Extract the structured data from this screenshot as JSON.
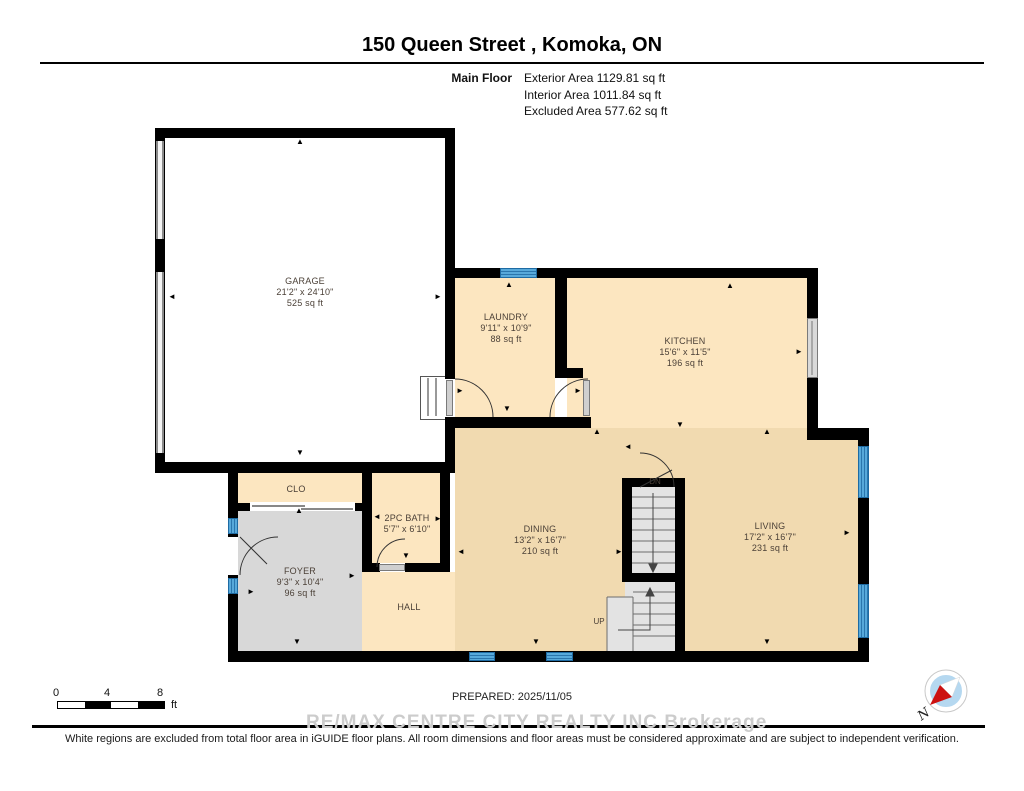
{
  "header": {
    "title": "150 Queen Street , Komoka, ON",
    "floor_label": "Main Floor",
    "stats": [
      "Exterior Area 1129.81 sq ft",
      "Interior Area 1011.84 sq ft",
      "Excluded Area 577.62 sq ft"
    ]
  },
  "rooms": [
    {
      "id": "garage",
      "name": "GARAGE",
      "dims": "21'2\" x 24'10\"",
      "area": "525 sq ft"
    },
    {
      "id": "laundry",
      "name": "LAUNDRY",
      "dims": "9'11\" x 10'9\"",
      "area": "88 sq ft"
    },
    {
      "id": "kitchen",
      "name": "KITCHEN",
      "dims": "15'6\" x 11'5\"",
      "area": "196 sq ft"
    },
    {
      "id": "dining",
      "name": "DINING",
      "dims": "13'2\" x 16'7\"",
      "area": "210 sq ft"
    },
    {
      "id": "living",
      "name": "LIVING",
      "dims": "17'2\" x 16'7\"",
      "area": "231 sq ft"
    },
    {
      "id": "foyer",
      "name": "FOYER",
      "dims": "9'3\" x 10'4\"",
      "area": "96 sq ft"
    },
    {
      "id": "bath",
      "name": "2PC BATH",
      "dims": "5'7\" x 6'10\"",
      "area": ""
    },
    {
      "id": "closet",
      "name": "CLO",
      "dims": "",
      "area": ""
    },
    {
      "id": "hall",
      "name": "HALL",
      "dims": "",
      "area": ""
    }
  ],
  "stairs": {
    "dn_label": "DN",
    "up_label": "UP"
  },
  "scale_bar": {
    "ticks": [
      "0",
      "4",
      "8"
    ],
    "unit": "ft"
  },
  "prepared": "PREPARED: 2025/11/05",
  "watermark": {
    "brand": "RE/MAX CENTRE CITY REALTY INC.",
    "suffix": "Brokerage"
  },
  "disclaimer": "White regions are excluded from total floor area in iGUIDE floor plans. All room dimensions and floor areas must be considered approximate and are subject to independent verification.",
  "compass": {
    "label": "N"
  },
  "colors": {
    "wall": "#000000",
    "room_cream": "#fce6c0",
    "room_tan": "#f1dab0",
    "foyer_gray": "#d8d8d8",
    "stair_gray": "#e3e3e3",
    "window_blue": "#57a9da",
    "window_stripe": "#2a76ad",
    "compass_red": "#cc1111",
    "compass_blue": "#b5d8f0",
    "watermark_gray": "#cccccc"
  }
}
